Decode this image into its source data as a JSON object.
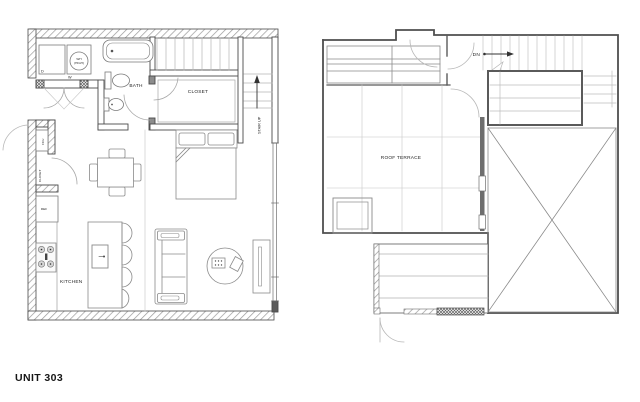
{
  "page": {
    "footer_label": "UNIT 303"
  },
  "colors": {
    "background": "#ffffff",
    "wall_line": "#4a4a4a",
    "fixture_line": "#7a7a7a",
    "light_line": "#bdbdbd",
    "hatch_line": "#9a9a9a",
    "text": "#1f1f1f"
  },
  "floor_plan": {
    "title": "unit interior plan",
    "labels": {
      "dryer": "D",
      "washer": "W",
      "water_heater_line1": "WH",
      "water_heater_line2": "(HIGH)",
      "bath": "BATH",
      "closet_room": "CLOSET",
      "stair_up": "STAIR UP",
      "fcu": "FCU",
      "entry_closet": "CLOSET",
      "refrigerator": "REF",
      "kitchen": "KITCHEN"
    }
  },
  "roof_plan": {
    "title": "roof terrace plan",
    "labels": {
      "down": "DN",
      "roof_terrace": "ROOF TERRACE"
    }
  }
}
